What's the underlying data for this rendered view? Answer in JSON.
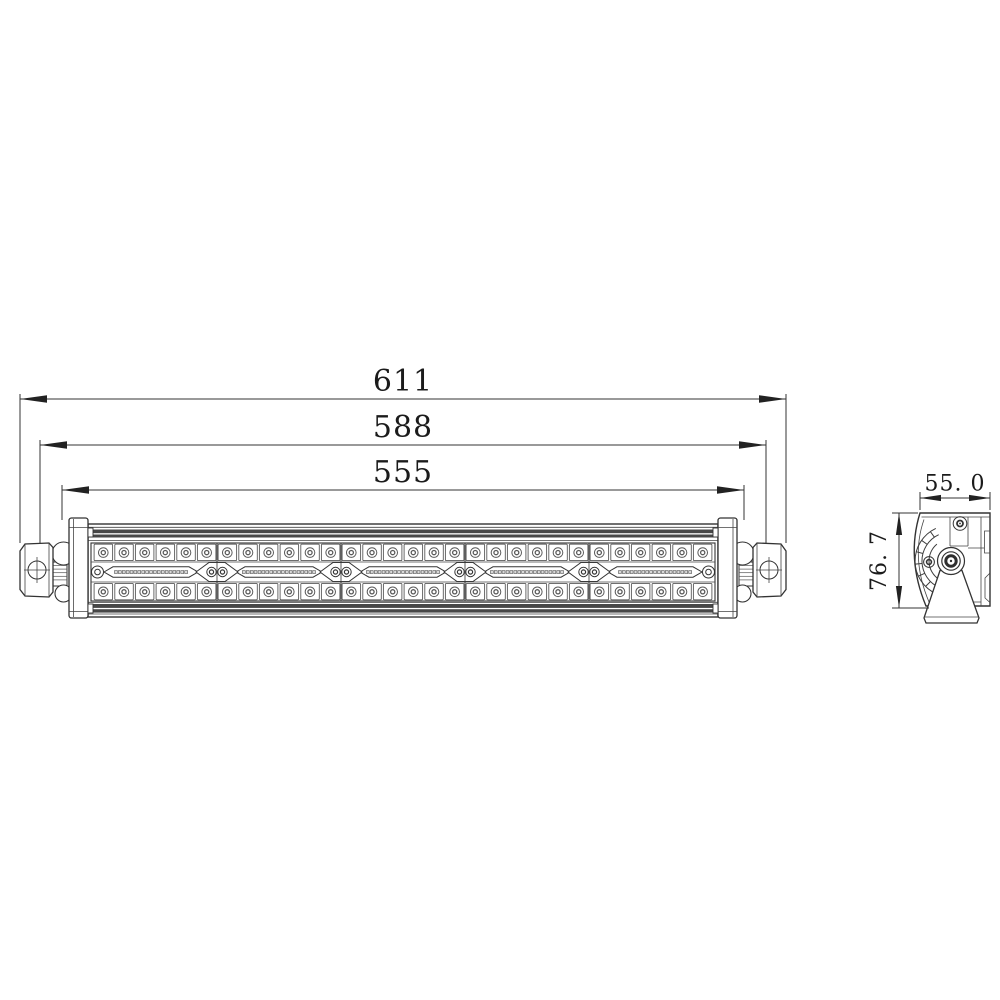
{
  "front_view": {
    "dim_total": "611",
    "dim_mount": "588",
    "dim_body": "555",
    "led_columns": 30,
    "led_rows": 2,
    "module_count": 5,
    "screw_diamond_count": 4,
    "connector_slot_count": 5,
    "slot_pin_count": 19
  },
  "side_view": {
    "dim_width": "55. 0",
    "dim_height": "76. 7"
  },
  "colors": {
    "line": "#333333",
    "dark_band": "#474747",
    "led_ring": "#5a5a5a",
    "pin_fill": "#d8d8d8"
  }
}
